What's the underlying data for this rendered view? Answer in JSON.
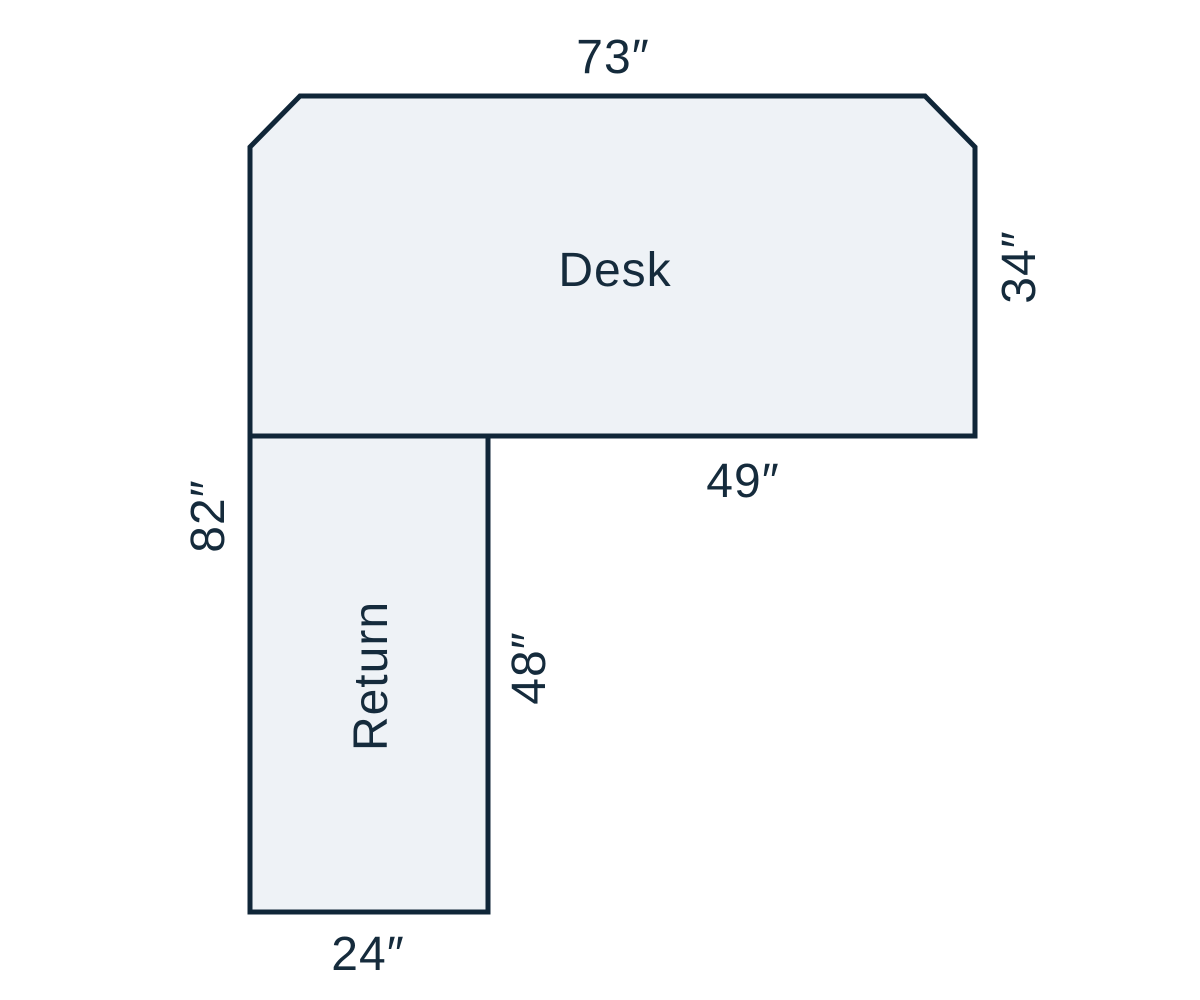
{
  "diagram": {
    "shapes": {
      "desk": {
        "label": "Desk"
      },
      "return": {
        "label": "Return"
      }
    },
    "dimensions": {
      "desk_top_width": "73″",
      "desk_right_depth": "34″",
      "desk_bottom_right_span": "49″",
      "left_total_height": "82″",
      "return_right_length": "48″",
      "return_bottom_width": "24″"
    },
    "colors": {
      "shape_fill": "#eef2f6",
      "shape_stroke": "#102638",
      "text": "#152b3c",
      "background": "#ffffff"
    }
  }
}
